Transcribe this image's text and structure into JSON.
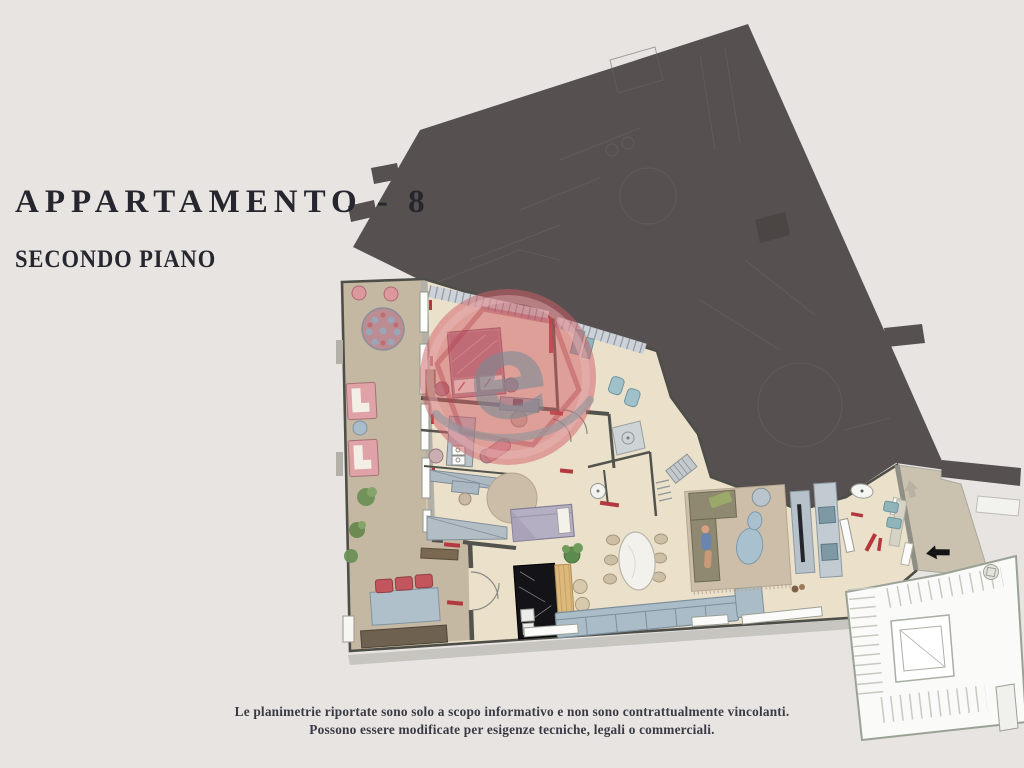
{
  "header": {
    "title": "APPARTAMENTO - 8",
    "subtitle": "SECONDO PIANO"
  },
  "footer": {
    "line1": "Le planimetrie riportate sono solo a scopo informativo e non sono contrattualmente vincolanti.",
    "line2": "Possono essere modificate per esigenze tecniche, legali o commerciali."
  },
  "watermark": {
    "letter": "e"
  },
  "palette": {
    "background": "#e7e4e2",
    "adjacent_unit": "#575050",
    "floor": "#ebe1cb",
    "terrace": "#c5b8a3",
    "landing": "#cbc1af",
    "watermark_red": "#cf5f66",
    "accent_red": "#b23a3e",
    "title_text": "#26262e",
    "footer_text": "#3a3a44"
  }
}
